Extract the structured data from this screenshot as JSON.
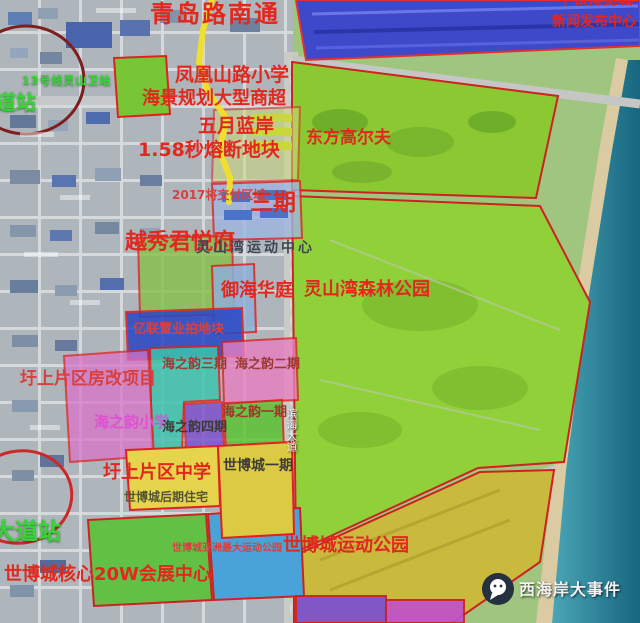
{
  "map": {
    "region": "灵山湾 / 世博城 片区卫星规划图",
    "colors": {
      "parcel_border_red": "#cc2222",
      "golf_green": "#8cc832",
      "forest_green": "#90d13a",
      "sea_teal": "#2e8da6",
      "sand": "#dbcba2",
      "factory_blue": "#3d49c8",
      "metro_line_yellow": "#f2e028",
      "label_red": "#e2281e",
      "station_green": "#38d438",
      "label_magenta": "#e14fd2",
      "city_gray": "#aeb5bb",
      "expo_yellow": "#dcc944",
      "sport_park_olive": "#c9b93c",
      "expo_core_green": "#62c145",
      "expo_blue": "#4aa3d8"
    },
    "labels": [
      {
        "name": "qingdao-road",
        "text": "青岛路南通"
      },
      {
        "name": "zhongtie-expo",
        "text": "中铁博览城"
      },
      {
        "name": "news-center",
        "text": "新闻发布中心"
      },
      {
        "name": "fenghuang-primary-school",
        "text": "凤凰山路小学"
      },
      {
        "name": "haijing-mall",
        "text": "海景规划大型商超"
      },
      {
        "name": "wuyue-lanan",
        "text": "五月蓝岸"
      },
      {
        "name": "rongduan-plot",
        "text": "1.58秒熔断地块"
      },
      {
        "name": "dongfang-golf",
        "text": "东方高尔夫"
      },
      {
        "name": "delivery-2017",
        "text": "2017将交付区域"
      },
      {
        "name": "phase3",
        "text": "三期"
      },
      {
        "name": "yuexiu-junyuefu",
        "text": "越秀君悦府"
      },
      {
        "name": "lingshanwan-sports-center",
        "text": "灵山湾运动中心"
      },
      {
        "name": "yuhai-huating",
        "text": "御海华庭"
      },
      {
        "name": "lingshanwan-forest-park",
        "text": "灵山湾森林公园"
      },
      {
        "name": "land-auction-plot",
        "text": "亿联置业拍地块"
      },
      {
        "name": "haizhiyun-phase3",
        "text": "海之韵三期"
      },
      {
        "name": "haizhiyun-phase2",
        "text": "海之韵二期"
      },
      {
        "name": "housing-reform-project",
        "text": "圩上片区房改项目"
      },
      {
        "name": "haizhiyun-primary-school",
        "text": "海之韵小学"
      },
      {
        "name": "haizhiyun-phase4",
        "text": "海之韵四期"
      },
      {
        "name": "haizhiyun-phase1",
        "text": "海之韵一期"
      },
      {
        "name": "district-middle-school",
        "text": "圩上片区中学"
      },
      {
        "name": "expo-city-phase1",
        "text": "世博城一期"
      },
      {
        "name": "expo-city-later-residential",
        "text": "世博城后期住宅"
      },
      {
        "name": "expo-city-sports-park",
        "text": "世博城运动公园"
      },
      {
        "name": "asia-largest-sports-park",
        "text": "世博城亚洲最大运动公园"
      },
      {
        "name": "expo-city-core-center",
        "text": "世博城核心20W会展中心"
      },
      {
        "name": "dadao-station",
        "text": "大道站"
      },
      {
        "name": "dao-station",
        "text": "道站"
      },
      {
        "name": "line13-station",
        "text": "13号线灵山卫站"
      },
      {
        "name": "binhai-avenue",
        "text": "滨海大道"
      },
      {
        "name": "wechat-account",
        "text": "西海岸大事件"
      }
    ]
  }
}
